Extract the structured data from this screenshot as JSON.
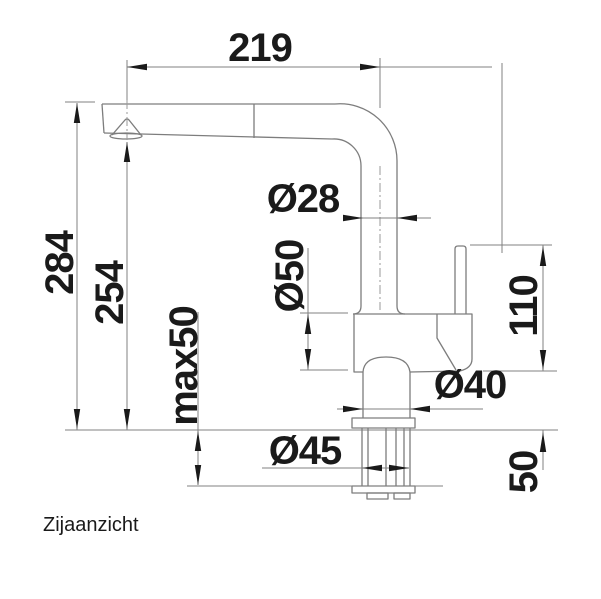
{
  "drawing": {
    "caption": "Zijaanzicht",
    "dimensions": {
      "reach": "219",
      "height_total": "284",
      "height_outlet": "254",
      "max_mounting_thickness": "max50",
      "spout_pipe_diameter": "Ø28",
      "body_diameter": "Ø50",
      "lever_height": "110",
      "base_diameter": "Ø40",
      "shank_diameter": "Ø45",
      "under_counter_length": "50"
    },
    "colors": {
      "line": "#7d7d7d",
      "text": "#1a1a1a",
      "background": "#ffffff"
    }
  }
}
